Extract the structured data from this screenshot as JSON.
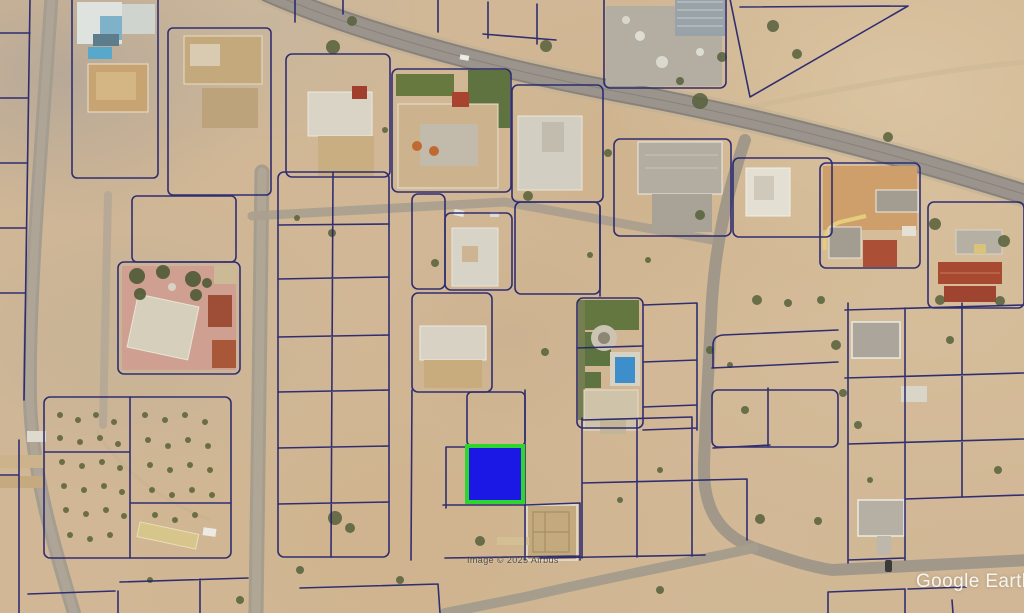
{
  "app": {
    "name": "Google Earth",
    "view": "satellite-imagery-with-cadastral-parcels"
  },
  "watermarks": {
    "brand": "Google Earth",
    "imagery_credit": "Image © 2025 Airbus"
  },
  "selected_parcel": {
    "x": 467,
    "y": 446,
    "width": 56,
    "height": 56,
    "fill_color": "#1b18e6",
    "border_color": "#2ed52e"
  },
  "palette": {
    "sand": "#d1b795",
    "road": "#9b948c",
    "parcel_line": "#23236e",
    "vegetation": "#56613b",
    "pool": "#3e8ecb"
  }
}
